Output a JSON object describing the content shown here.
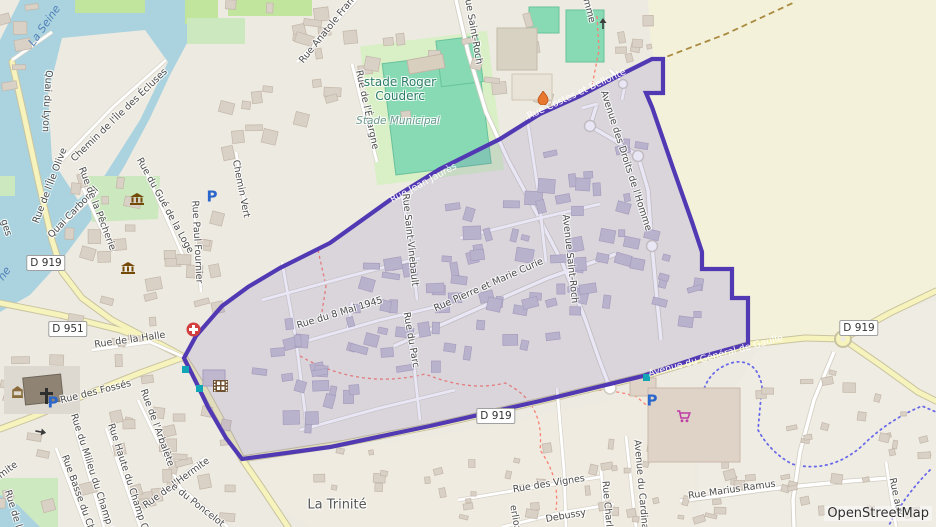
{
  "map": {
    "attribution": "OpenStreetMap",
    "boundary": {
      "stroke": "#5239B4",
      "fill_rgba": "rgba(97,84,186,0.14)",
      "points": [
        184,
        358,
        196,
        336,
        222,
        306,
        248,
        287,
        280,
        268,
        330,
        243,
        390,
        200,
        440,
        169,
        500,
        139,
        540,
        114,
        580,
        96,
        622,
        74,
        652,
        59,
        663,
        59,
        663,
        93,
        646,
        93,
        652,
        107,
        673,
        168,
        692,
        222,
        702,
        252,
        702,
        269,
        732,
        269,
        732,
        298,
        748,
        298,
        748,
        344,
        700,
        357,
        643,
        376,
        540,
        401,
        430,
        426,
        330,
        447,
        242,
        459,
        226,
        438,
        208,
        407,
        196,
        382
      ]
    },
    "badges": [
      {
        "text": "D 919",
        "x": 46,
        "y": 263
      },
      {
        "text": "D 951",
        "x": 68,
        "y": 329
      },
      {
        "text": "D 919",
        "x": 496,
        "y": 416
      },
      {
        "text": "D 919",
        "x": 859,
        "y": 328
      }
    ],
    "labels": [
      {
        "text": "La Seine",
        "x": 45,
        "y": 26,
        "rot": -55,
        "cls": "wa"
      },
      {
        "text": "Quai du Lyon",
        "x": 46,
        "y": 101,
        "rot": 93,
        "cls": "st"
      },
      {
        "text": "Chemin de l'Île des Écluses",
        "x": 120,
        "y": 116,
        "rot": -44,
        "cls": "st"
      },
      {
        "text": "Rue de l'Île Olive",
        "x": 51,
        "y": 186,
        "rot": -69,
        "cls": "st"
      },
      {
        "text": "ges",
        "x": 5,
        "y": 228,
        "rot": 72,
        "cls": "st"
      },
      {
        "text": "ne",
        "x": 5,
        "y": 274,
        "rot": -55,
        "cls": "wa"
      },
      {
        "text": "Quai Carbonel",
        "x": 74,
        "y": 213,
        "rot": -46,
        "cls": "st"
      },
      {
        "text": "Rue de la Pêcherie",
        "x": 96,
        "y": 209,
        "rot": 69,
        "cls": "st"
      },
      {
        "text": "Rue du Gué de la Loge",
        "x": 164,
        "y": 206,
        "rot": 61,
        "cls": "st"
      },
      {
        "text": "Rue Paul Fournier",
        "x": 196,
        "y": 242,
        "rot": 87,
        "cls": "st"
      },
      {
        "text": "Chemin Vert",
        "x": 240,
        "y": 189,
        "rot": 79,
        "cls": "st"
      },
      {
        "text": "Rue Anatole France",
        "x": 331,
        "y": 27,
        "rot": -51,
        "cls": "st"
      },
      {
        "text": "Rue de l'Épargne",
        "x": 366,
        "y": 110,
        "rot": 78,
        "cls": "st"
      },
      {
        "text": "stade Roger\nCouderc",
        "x": 400,
        "y": 90,
        "rot": 0,
        "cls": "stad"
      },
      {
        "text": "Stade Municipal",
        "x": 398,
        "y": 121,
        "rot": 0,
        "cls": "stadsub"
      },
      {
        "text": "nue Saint-Roch",
        "x": 472,
        "y": 29,
        "rot": 80,
        "cls": "st"
      },
      {
        "text": "Rue Costes et Bellonte",
        "x": 577,
        "y": 95,
        "rot": -25,
        "cls": "onp"
      },
      {
        "text": "mme",
        "x": 588,
        "y": 11,
        "rot": 75,
        "cls": "st"
      },
      {
        "text": "Avenue des Droits de l'Homme",
        "x": 625,
        "y": 161,
        "rot": 72,
        "cls": "st"
      },
      {
        "text": "Rue Jean Jaurès",
        "x": 424,
        "y": 184,
        "rot": -28,
        "cls": "onp"
      },
      {
        "text": "Avenue Saint-Roch",
        "x": 569,
        "y": 259,
        "rot": 84,
        "cls": "st"
      },
      {
        "text": "Rue Saint-Vinebault",
        "x": 409,
        "y": 240,
        "rot": 84,
        "cls": "st"
      },
      {
        "text": "Rue Pierre et Marie Curie",
        "x": 489,
        "y": 286,
        "rot": -24,
        "cls": "st"
      },
      {
        "text": "Rue du 8 Mai 1945",
        "x": 340,
        "y": 314,
        "rot": -17,
        "cls": "st"
      },
      {
        "text": "Rue du Parc",
        "x": 410,
        "y": 340,
        "rot": 80,
        "cls": "st"
      },
      {
        "text": "Rue de la Halle",
        "x": 130,
        "y": 341,
        "rot": -8,
        "cls": "st"
      },
      {
        "text": "Rue des Fossés",
        "x": 96,
        "y": 393,
        "rot": -14,
        "cls": "st"
      },
      {
        "text": "Rue de l'Arbalète",
        "x": 156,
        "y": 428,
        "rot": 70,
        "cls": "st"
      },
      {
        "text": "Rue du Milieu du Champ Cal",
        "x": 93,
        "y": 478,
        "rot": 72,
        "cls": "st"
      },
      {
        "text": "Rue Haute du Champ Cal",
        "x": 128,
        "y": 481,
        "rot": 72,
        "cls": "st"
      },
      {
        "text": "Rue Basse du Cha",
        "x": 78,
        "y": 496,
        "rot": 70,
        "cls": "st"
      },
      {
        "text": "Rue de l'Hermite",
        "x": 177,
        "y": 484,
        "rot": -36,
        "cls": "st"
      },
      {
        "text": "rmite",
        "x": 7,
        "y": 472,
        "rot": -36,
        "cls": "st"
      },
      {
        "text": "e du Poncelot",
        "x": 197,
        "y": 506,
        "rot": 38,
        "cls": "st"
      },
      {
        "text": "Rue de l",
        "x": 12,
        "y": 509,
        "rot": 73,
        "cls": "st"
      },
      {
        "text": "La Trinité",
        "x": 337,
        "y": 506,
        "rot": 0,
        "cls": "loc"
      },
      {
        "text": "Rue des Vignes",
        "x": 549,
        "y": 485,
        "rot": -9,
        "cls": "st"
      },
      {
        "text": "Debussy",
        "x": 566,
        "y": 517,
        "rot": -10,
        "cls": "st"
      },
      {
        "text": "erlioz",
        "x": 514,
        "y": 518,
        "rot": 80,
        "cls": "st"
      },
      {
        "text": "Rue Charl",
        "x": 606,
        "y": 504,
        "rot": 85,
        "cls": "st"
      },
      {
        "text": "Avenue du Cardinal",
        "x": 640,
        "y": 486,
        "rot": 85,
        "cls": "st"
      },
      {
        "text": "Rue Marius Ramus",
        "x": 732,
        "y": 491,
        "rot": -8,
        "cls": "st"
      },
      {
        "text": "Rue aux",
        "x": 895,
        "y": 497,
        "rot": 78,
        "cls": "st"
      },
      {
        "text": "Avenue du Général de Gaulle",
        "x": 716,
        "y": 357,
        "rot": -15,
        "cls": "onp"
      }
    ],
    "icons": [
      {
        "type": "museum-icon",
        "x": 130,
        "y": 193
      },
      {
        "type": "museum-icon",
        "x": 121,
        "y": 262
      },
      {
        "type": "parking-icon",
        "x": 212,
        "y": 197
      },
      {
        "type": "parking-icon",
        "x": 53,
        "y": 403
      },
      {
        "type": "parking-icon",
        "x": 652,
        "y": 401
      },
      {
        "type": "hospital-icon",
        "x": 186,
        "y": 322
      },
      {
        "type": "cinema-icon",
        "x": 213,
        "y": 380
      },
      {
        "type": "church-icon",
        "x": 40,
        "y": 388
      },
      {
        "type": "townhall-icon",
        "x": 11,
        "y": 386
      },
      {
        "type": "flame-icon",
        "x": 537,
        "y": 91
      },
      {
        "type": "supermarket-icon",
        "x": 676,
        "y": 410
      },
      {
        "type": "busstop-icon",
        "x": 182,
        "y": 366
      },
      {
        "type": "busstop-icon",
        "x": 196,
        "y": 385
      },
      {
        "type": "busstop-icon",
        "x": 643,
        "y": 374
      },
      {
        "type": "oneway-arrow-icon",
        "x": 36,
        "y": 427,
        "rot": 10
      },
      {
        "type": "oneway-arrow-icon",
        "x": 599,
        "y": 29,
        "rot": -90
      }
    ],
    "colors": {
      "water": "#AAD3DF",
      "farmland": "#F3F1DA",
      "pitch": "#87DAB4",
      "grass": "#D9EFC6",
      "park": "#CBE8BF",
      "road_secondary": "#F6F3BD",
      "building_out": "#D9D0C6",
      "building_in": "#C8C2D0"
    }
  }
}
